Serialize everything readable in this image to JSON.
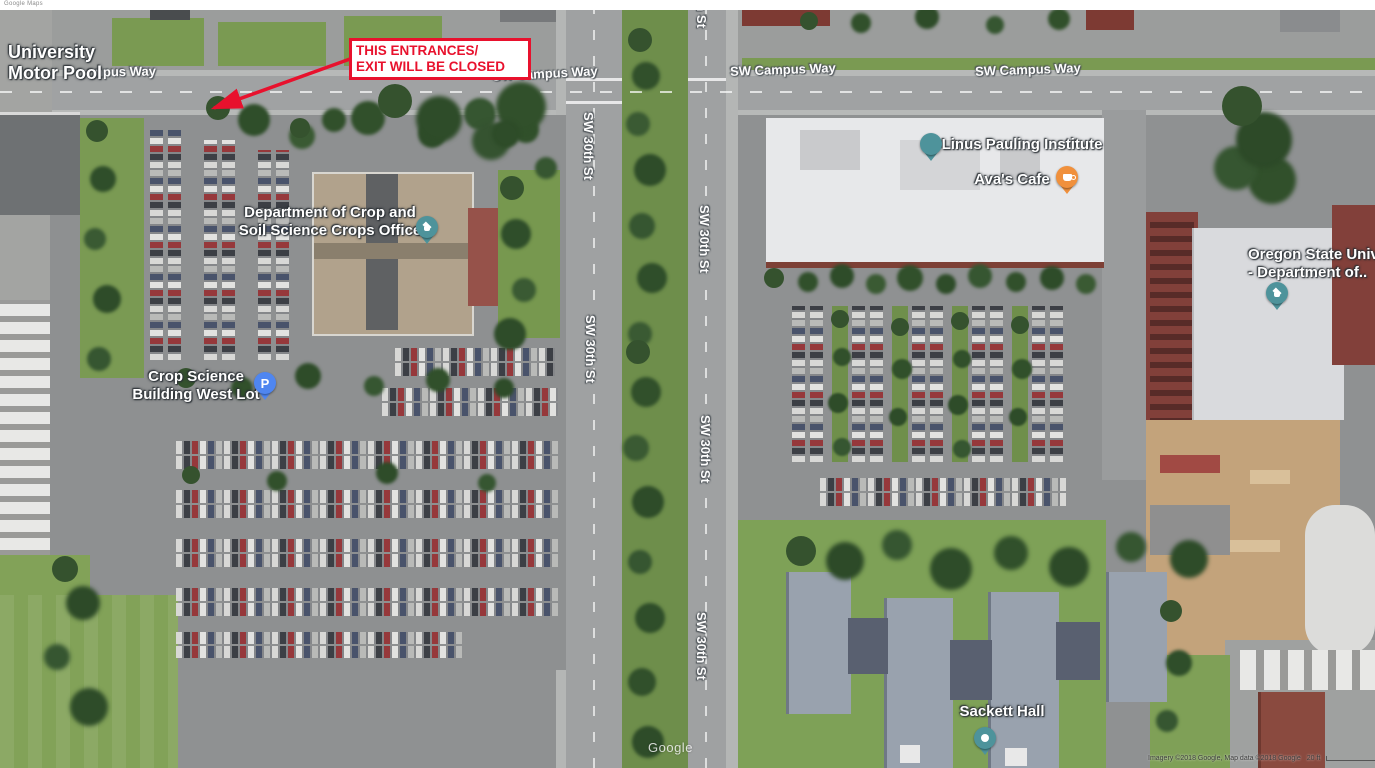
{
  "header": {
    "logo_text": "Google Maps"
  },
  "map": {
    "watermark": "Google",
    "attribution": "Imagery ©2018 Google, Map data ©2018 Google",
    "scale_label": "20 ft"
  },
  "colors": {
    "annotation_red": "#e8112d",
    "education_pin": "#4e939b",
    "parking_pin": "#4f86f0",
    "cafe_pin": "#f0903c"
  },
  "annotation_box": {
    "line1": "THIS ENTRANCES/",
    "line2": "EXIT WILL BE CLOSED"
  },
  "road_labels": [
    {
      "id": "campus-way-partial",
      "text": "npus Way",
      "x": 95,
      "y": 64,
      "rotate": -1,
      "vertical": false
    },
    {
      "id": "campus-way-1",
      "text": "SW Campus Way",
      "x": 492,
      "y": 66,
      "rotate": -3,
      "vertical": false
    },
    {
      "id": "campus-way-2",
      "text": "SW Campus Way",
      "x": 730,
      "y": 62,
      "rotate": -2,
      "vertical": false
    },
    {
      "id": "campus-way-3",
      "text": "SW Campus Way",
      "x": 975,
      "y": 62,
      "rotate": -2,
      "vertical": false
    },
    {
      "id": "30th-st-top",
      "text": "SW 30th St",
      "x": 694,
      "y": -40,
      "rotate": 0,
      "vertical": true
    },
    {
      "id": "30th-st-1",
      "text": "SW 30th St",
      "x": 581,
      "y": 112,
      "rotate": 0,
      "vertical": true
    },
    {
      "id": "30th-st-2",
      "text": "SW 30th St",
      "x": 697,
      "y": 205,
      "rotate": 0,
      "vertical": true
    },
    {
      "id": "30th-st-3",
      "text": "SW 30th St",
      "x": 583,
      "y": 315,
      "rotate": 0,
      "vertical": true
    },
    {
      "id": "30th-st-4",
      "text": "SW 30th St",
      "x": 698,
      "y": 415,
      "rotate": 0,
      "vertical": true
    },
    {
      "id": "30th-st-5",
      "text": "SW 30th St",
      "x": 694,
      "y": 612,
      "rotate": 0,
      "vertical": true
    }
  ],
  "place_labels": [
    {
      "id": "university-motor-pool",
      "lines": [
        "University",
        "Motor Pool"
      ],
      "x": 8,
      "y": 42,
      "size": 18,
      "align": "left"
    },
    {
      "id": "dept-crop-soil",
      "lines": [
        "Department of Crop and",
        "Soil Science Crops Office"
      ],
      "x": 330,
      "y": 204,
      "size": 15,
      "align": "center"
    },
    {
      "id": "linus-pauling",
      "lines": [
        "Linus Pauling Institute"
      ],
      "x": 1022,
      "y": 136,
      "size": 15,
      "align": "center"
    },
    {
      "id": "avas-cafe",
      "lines": [
        "Ava's Cafe"
      ],
      "x": 1012,
      "y": 171,
      "size": 15,
      "align": "center"
    },
    {
      "id": "oregon-state-dept",
      "lines": [
        "Oregon State Univ",
        "- Department of.."
      ],
      "x": 1248,
      "y": 246,
      "size": 15,
      "align": "left"
    },
    {
      "id": "crop-science-west-lot",
      "lines": [
        "Crop Science",
        "Building West Lot"
      ],
      "x": 196,
      "y": 368,
      "size": 15,
      "align": "center"
    },
    {
      "id": "sackett-hall",
      "lines": [
        "Sackett Hall"
      ],
      "x": 1002,
      "y": 703,
      "size": 15,
      "align": "center"
    }
  ],
  "pins": [
    {
      "id": "dept-crop-soil",
      "type": "education",
      "x": 416,
      "y": 216,
      "color": "#4e939b",
      "glyph": ""
    },
    {
      "id": "linus-pauling",
      "type": "plain",
      "x": 920,
      "y": 133,
      "color": "#4e939b",
      "glyph": ""
    },
    {
      "id": "avas-cafe",
      "type": "cafe",
      "x": 1056,
      "y": 166,
      "color": "#f0903c",
      "glyph": ""
    },
    {
      "id": "oregon-state",
      "type": "education",
      "x": 1266,
      "y": 282,
      "color": "#4e939b",
      "glyph": ""
    },
    {
      "id": "crop-science-lot",
      "type": "parking",
      "x": 254,
      "y": 372,
      "color": "#4f86f0",
      "glyph": "P"
    },
    {
      "id": "sackett-hall",
      "type": "dot",
      "x": 974,
      "y": 727,
      "color": "#4e939b",
      "glyph": ""
    }
  ]
}
